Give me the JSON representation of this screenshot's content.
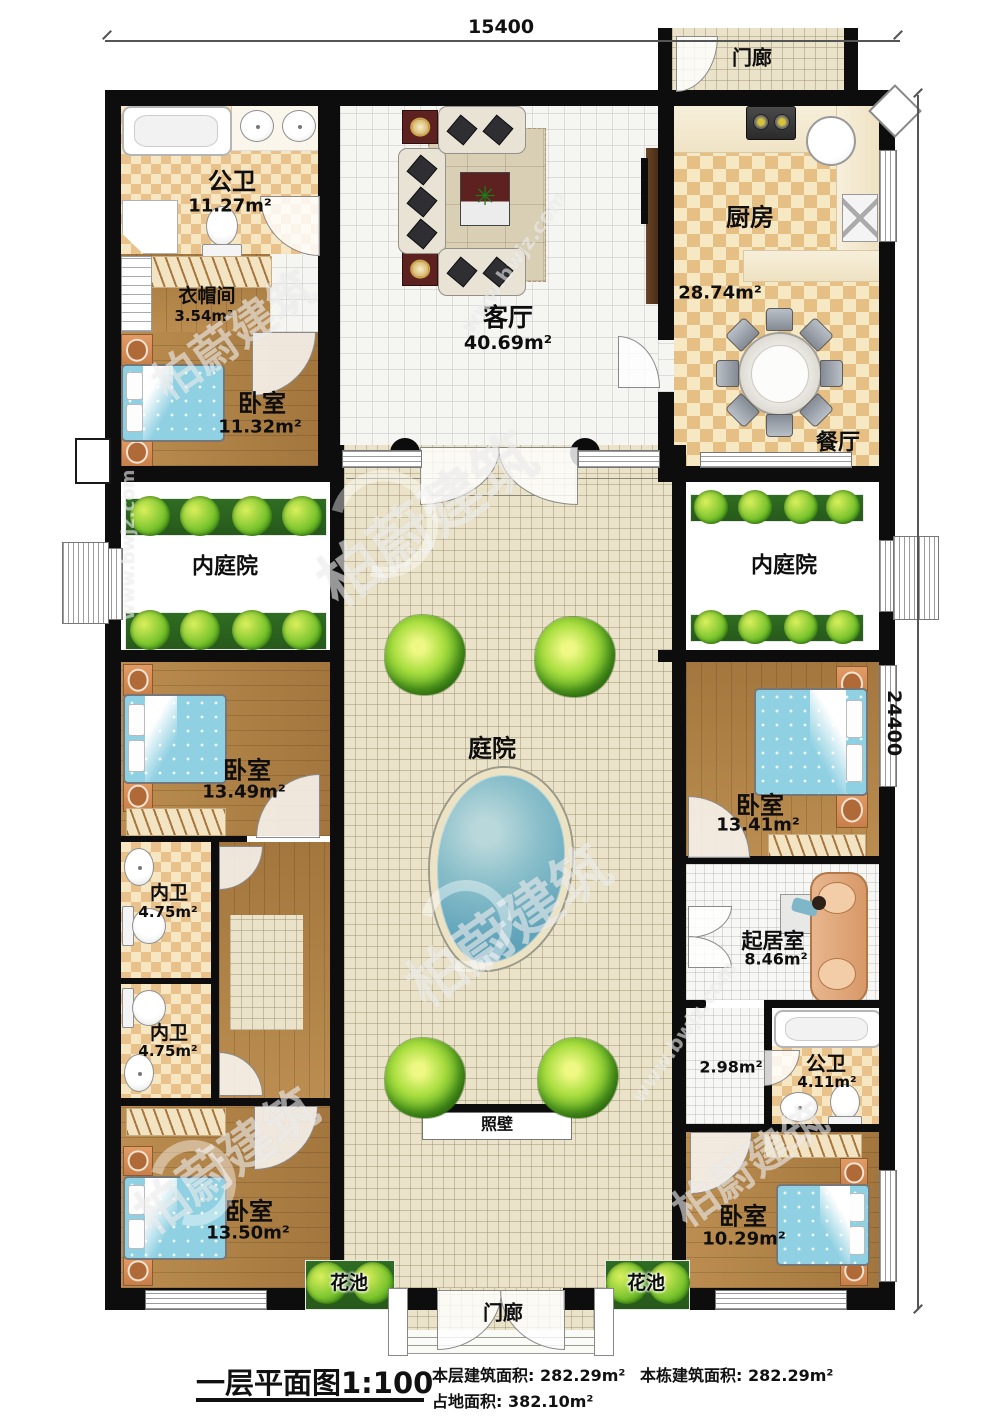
{
  "dimensions": {
    "top": "15400",
    "right": "24400"
  },
  "watermark": {
    "brand": "柏蔚建筑",
    "site": "www.bwjz.com"
  },
  "rooms": {
    "porch_top": {
      "label": "门廊"
    },
    "bath_top": {
      "label": "公卫",
      "area": "11.27m²"
    },
    "cloak": {
      "label": "衣帽间",
      "area": "3.54m²"
    },
    "bedroom_nw": {
      "label": "卧室",
      "area": "11.32m²"
    },
    "living": {
      "label": "客厅",
      "area": "40.69m²"
    },
    "kitchen": {
      "label": "厨房",
      "area": "28.74m²"
    },
    "dining": {
      "label": "餐厅"
    },
    "court_left": {
      "label": "内庭院"
    },
    "court_right": {
      "label": "内庭院"
    },
    "courtyard": {
      "label": "庭院"
    },
    "bedroom_w1": {
      "label": "卧室",
      "area": "13.49m²"
    },
    "bath_w1": {
      "label": "内卫",
      "area": "4.75m²"
    },
    "bath_w2": {
      "label": "内卫",
      "area": "4.75m²"
    },
    "bedroom_w2": {
      "label": "卧室",
      "area": "13.50m²"
    },
    "bedroom_e1": {
      "label": "卧室",
      "area": "13.41m²"
    },
    "sitting": {
      "label": "起居室",
      "area": "8.46m²"
    },
    "hall": {
      "area": "2.98m²"
    },
    "bath_se": {
      "label": "公卫",
      "area": "4.11m²"
    },
    "bedroom_se": {
      "label": "卧室",
      "area": "10.29m²"
    },
    "flower_left": {
      "label": "花池"
    },
    "flower_right": {
      "label": "花池"
    },
    "screen_wall": {
      "label": "照壁"
    },
    "porch_bottom": {
      "label": "门廊"
    }
  },
  "footer": {
    "title": "一层平面图1:100",
    "floor_area_label": "本层建筑面积:",
    "floor_area": "282.29m²",
    "land_area_label": "占地面积:",
    "land_area": "382.10m²",
    "building_area_label": "本栋建筑面积:",
    "building_area": "282.29m²"
  }
}
